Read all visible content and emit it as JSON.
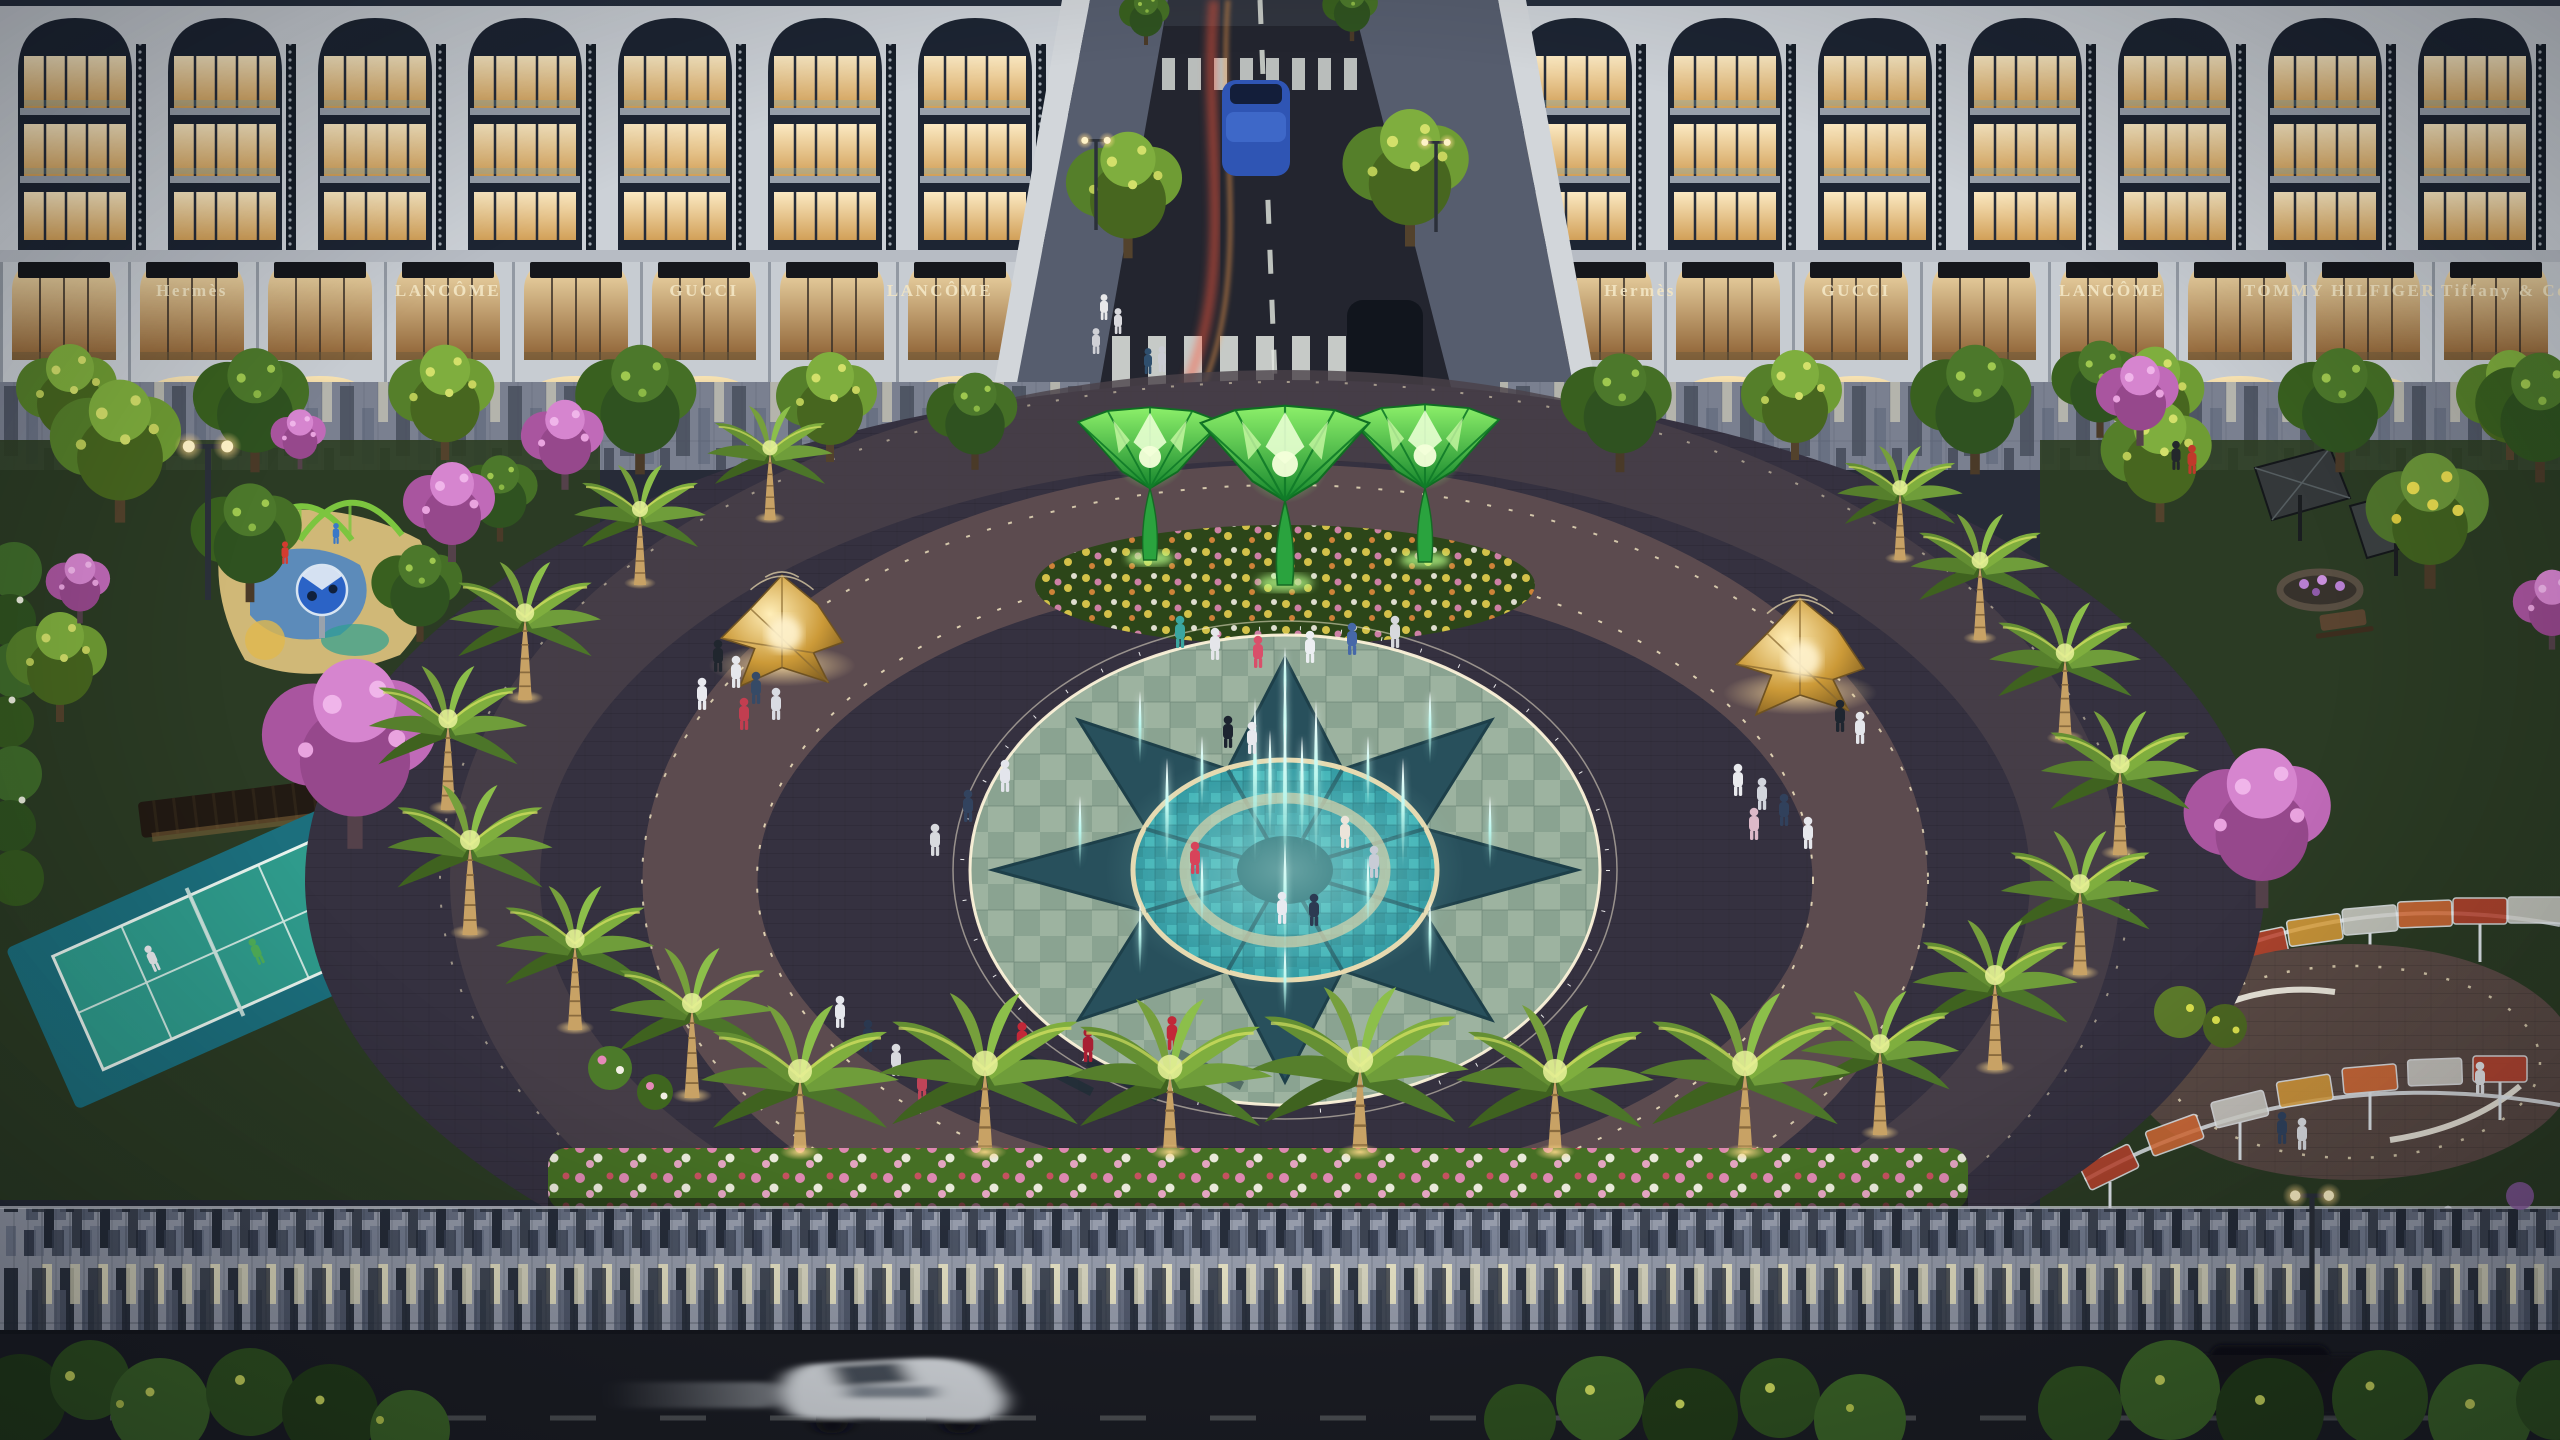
{
  "scene": {
    "title": "Night aerial rendering of a luxury mixed-use plaza",
    "type": "3D architectural visualization",
    "time_of_day": "dusk / night",
    "view": "elevated aerial view toward twin white colonnade retail blocks, a central avenue and an oval fountain plaza ringed by lit palm trees"
  },
  "signs": {
    "left": [
      "Hermès",
      "LANCÔME",
      "GUCCI",
      "LANCÔME"
    ],
    "right": [
      "Hermès",
      "GUCCI",
      "LANCÔME",
      "TOMMY HILFIGER",
      "Tiffany & Co."
    ]
  },
  "elements": {
    "buildings": "two symmetric white arched-colonnade blocks, three lit residential floors above an illuminated ground-floor retail arcade",
    "street": "center avenue with dashed lane line, two zebra crosswalks, a blue van, a dark SUV and red tail-light trails",
    "lotus_sculptures": 3,
    "gold_pavilions": 2,
    "fountain": {
      "shape": "oval teal mosaic with 8-point star inlay",
      "jets": 21,
      "led_rings": 2
    },
    "plaza_led_arcs": 3,
    "palm_trees": 20,
    "pink_blossom_trees": 8,
    "amenities_left": [
      "children playground with blue sphere climber",
      "green swing frames",
      "timber pergola lounge",
      "tennis court"
    ],
    "amenities_right": [
      "angular umbrella shelter",
      "picnic terrace",
      "curved lattice canopy walk",
      "round community plaza"
    ],
    "foreground": [
      "flower hedge",
      "piano-key paved promenade",
      "asphalt road with red light trails",
      "white sedan in motion",
      "dark parked car",
      "uplit shrubs"
    ]
  },
  "palette": {
    "facade": "#ccd1d7",
    "facadeShadow": "#1d2533",
    "roof": "#262f3e",
    "windowGlow": "#f7e2b2",
    "arcadeGlow": "#f2d9a4",
    "signText": "#f3e6c4",
    "road": "#23252f",
    "sidewalk": "#565d6e",
    "laneMark": "#d9ded6",
    "trailRed": "#ff5a3c",
    "groundBase": "#272b38",
    "plazaBase": "#353140",
    "ringBrick": "#5f4d50",
    "ledWarm": "#f3e6c2",
    "checkerPale": "#9db3a0",
    "fountainTeal": "#2e97a0",
    "starDark": "#28505c",
    "jetCyan": "#bdf8ef",
    "lotusGreen": "#2aa33e",
    "lotusGlow": "#d9ffb0",
    "gold": "#d9a94e",
    "treeGreen": "#3d6326",
    "treeLit": "#6f9c34",
    "pinkTree": "#c06ab8",
    "yellowBloom": "#e4d84e",
    "palmFrond": "#5d8a33",
    "palmLit": "#c9d95e",
    "trunk": "#c8a265",
    "lawn": "#2c3d22",
    "hedge": "#456f24",
    "flowerPink": "#e589b8",
    "flowerWhite": "#f2efe4",
    "courtSurround": "#1c6f7d",
    "courtTeal": "#2f9b8c",
    "lineWhite": "#e8f4ee",
    "sand": "#d9bf7c",
    "playBlue": "#2b63c6",
    "swingGreen": "#7cc53f",
    "pianoBase": "#969cab",
    "pianoDark": "#2c3340",
    "pianoCream": "#e3dfc2",
    "carWhite": "#d7dbe0",
    "carDark": "#13161c",
    "uplight": "#ffd98a",
    "canopyOrange": "#de6f38"
  }
}
